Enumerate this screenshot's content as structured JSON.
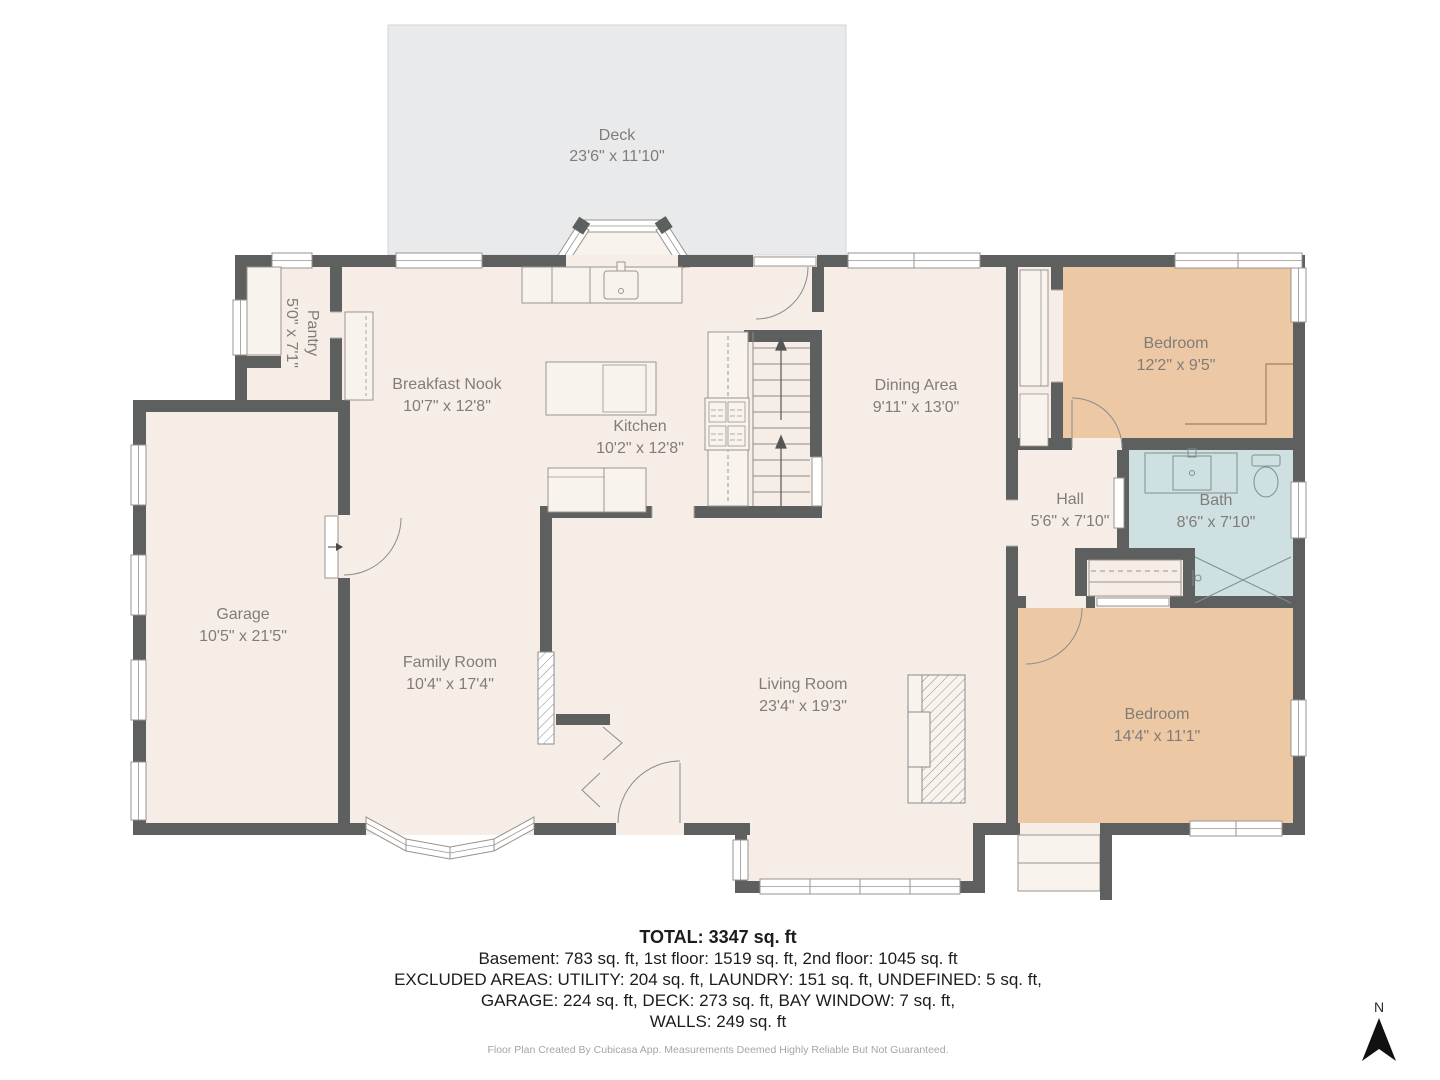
{
  "plan": {
    "rooms": [
      {
        "id": "deck",
        "name": "Deck",
        "dims": "23'6\" x 11'10\""
      },
      {
        "id": "pantry",
        "name": "Pantry",
        "dims": "5'0\" x 7'1\""
      },
      {
        "id": "breakfast-nook",
        "name": "Breakfast Nook",
        "dims": "10'7\" x 12'8\""
      },
      {
        "id": "kitchen",
        "name": "Kitchen",
        "dims": "10'2\" x 12'8\""
      },
      {
        "id": "dining-area",
        "name": "Dining Area",
        "dims": "9'11\" x 13'0\""
      },
      {
        "id": "bedroom-top-right",
        "name": "Bedroom",
        "dims": "12'2\" x 9'5\""
      },
      {
        "id": "hall",
        "name": "Hall",
        "dims": "5'6\" x 7'10\""
      },
      {
        "id": "bath",
        "name": "Bath",
        "dims": "8'6\" x 7'10\""
      },
      {
        "id": "garage",
        "name": "Garage",
        "dims": "10'5\" x 21'5\""
      },
      {
        "id": "family-room",
        "name": "Family Room",
        "dims": "10'4\" x 17'4\""
      },
      {
        "id": "living-room",
        "name": "Living Room",
        "dims": "23'4\" x 19'3\""
      },
      {
        "id": "bedroom-bottom-right",
        "name": "Bedroom",
        "dims": "14'4\" x 11'1\""
      }
    ],
    "compass": {
      "label": "N"
    },
    "colors": {
      "floor": "#f6ede7",
      "deck": "#e9eaec",
      "bedroom": "#ecc8a5",
      "bath": "#cee0e1",
      "wall": "#5e5f5f",
      "fixture_outline": "#9a938d"
    }
  },
  "summary": {
    "total": "TOTAL: 3347 sq. ft",
    "lines": [
      "Basement: 783 sq. ft, 1st floor: 1519 sq. ft, 2nd floor: 1045 sq. ft",
      "EXCLUDED AREAS: UTILITY: 204 sq. ft, LAUNDRY: 151 sq. ft, UNDEFINED: 5 sq. ft,",
      "GARAGE: 224 sq. ft, DECK: 273 sq. ft, BAY WINDOW: 7 sq. ft,",
      "WALLS: 249 sq. ft"
    ]
  },
  "footer": "Floor Plan Created By Cubicasa App. Measurements Deemed Highly Reliable But Not Guaranteed."
}
